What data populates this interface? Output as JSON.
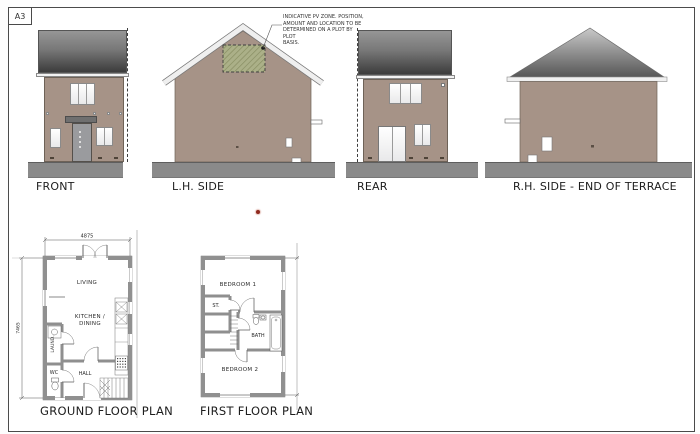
{
  "sheet": {
    "format": "A3"
  },
  "pv_annotation": {
    "lines": [
      "INDICATIVE PV ZONE. POSITION,",
      "AMOUNT AND LOCATION TO BE",
      "DETERMINED ON A PLOT BY PLOT",
      "BASIS."
    ]
  },
  "elevations": {
    "front": {
      "label": "FRONT"
    },
    "lh_side": {
      "label": "L.H. SIDE"
    },
    "rear": {
      "label": "REAR"
    },
    "rh_side": {
      "label": "R.H. SIDE - END OF TERRACE"
    }
  },
  "plans": {
    "ground": {
      "label": "GROUND FLOOR PLAN",
      "dims": {
        "width": "4875",
        "height": "7465"
      },
      "rooms": {
        "living": "LIVING",
        "kitchen_line1": "KITCHEN /",
        "kitchen_line2": "DINING",
        "laundry": "LAUND.",
        "wc": "WC",
        "hall": "HALL"
      }
    },
    "first": {
      "label": "FIRST FLOOR PLAN",
      "rooms": {
        "bedroom1": "BEDROOM 1",
        "store": "ST.",
        "bath": "BATH",
        "bedroom2": "BEDROOM 2"
      }
    }
  },
  "colors": {
    "wall": "#a69387",
    "roof_top": "#969696",
    "roof_bottom": "#3c3c3c",
    "ground": "#8a8a8a",
    "pv_zone": "#abb088",
    "marker_red": "#8f2a1f"
  }
}
